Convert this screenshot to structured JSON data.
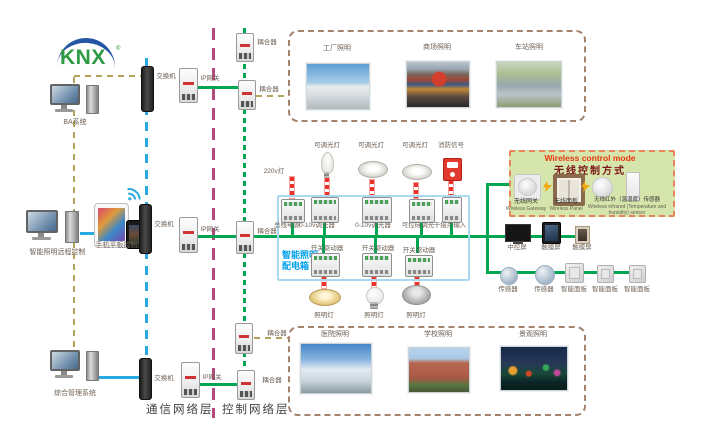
{
  "logo": {
    "text": "KNX",
    "reg": "®"
  },
  "left": {
    "pc1_label": "BA系统",
    "mobile_label": "手机平板控制端",
    "pc2_label": "智能照明远程控制",
    "pc3_label": "综合管理系统"
  },
  "common": {
    "switch": "交换机",
    "gateway": "IP网关",
    "coupler": "耦合器"
  },
  "footer": {
    "comm_layer": "通信网络层",
    "ctrl_layer": "控制网络层"
  },
  "photos": {
    "top": [
      {
        "label": "工厂照明"
      },
      {
        "label": "商场照明"
      },
      {
        "label": "车站照明"
      }
    ],
    "bottom": [
      {
        "label": "医院照明"
      },
      {
        "label": "学校照明"
      },
      {
        "label": "景观照明"
      }
    ]
  },
  "panel": {
    "title_line1": "智能照明",
    "title_line2": "配电箱",
    "source_label": "220v灯",
    "top_lamp_labels": [
      "可调光灯",
      "可调光灯",
      "可调光灯",
      "消防信号"
    ],
    "top_device_labels": [
      "总线电源",
      "0-10v调光器",
      "0-10v调光器",
      "可控硅调光",
      "干接点输入"
    ],
    "driver_labels": [
      "开关驱动器",
      "开关驱动器",
      "开关驱动器"
    ],
    "bottom_lamp_labels": [
      "照明灯",
      "照明灯",
      "照明灯"
    ]
  },
  "wireless": {
    "title_en": "Wireless control mode",
    "title_zh": "无线控制方式",
    "items": [
      {
        "zh": "无线网关",
        "en": "Wireless Gateway"
      },
      {
        "zh": "无线面板",
        "en": "Wireless Panel"
      },
      {
        "zh": "无线红外（温湿度）传感器",
        "en": "Wireless infrared (Temperature and humidity) sensor"
      }
    ]
  },
  "right": {
    "row1_labels": [
      "中控屏",
      "触摸屏",
      "触摸屏"
    ],
    "row2_labels": [
      "传感器",
      "传感器",
      "智能面板",
      "智能面板",
      "智能面板"
    ]
  },
  "colors": {
    "comm_blue": "#29abe2",
    "bus_green": "#00a651",
    "ctrl_magenta": "#b34a7d",
    "link_tan": "#b5a25a",
    "load_red": "#e60012",
    "panel_blue": "#00a0e9",
    "wireless_bg": "#d5e5ab",
    "wireless_border": "#e8845c"
  }
}
